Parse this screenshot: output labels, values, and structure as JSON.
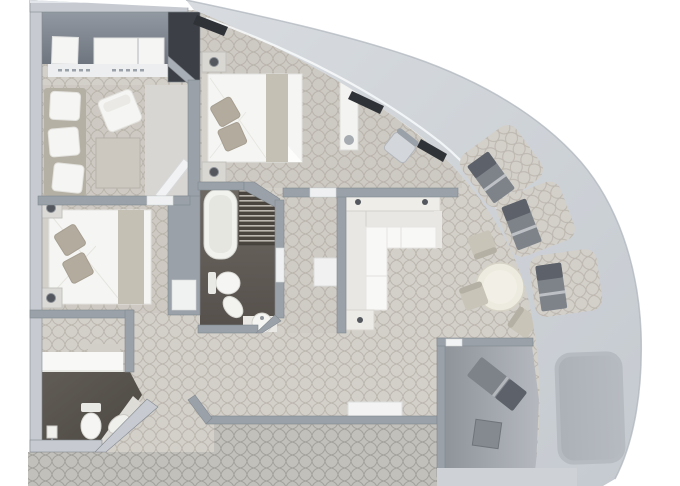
{
  "plan": {
    "kind": "floor-plan",
    "shape": "quarter-circle suite with curved hull balcony",
    "visible_text": [],
    "rooms": [
      {
        "name": "wardrobe-luggage-room",
        "furniture": [
          "storage-box",
          "luggage-bench",
          "sliding-closet-doors"
        ]
      },
      {
        "name": "sitting-room",
        "furniture": [
          "wall-sofa",
          "armchair",
          "coffee-table",
          "open-door"
        ]
      },
      {
        "name": "bedroom-2",
        "furniture": [
          "double-bed",
          "bed-runner",
          "pillows",
          "nightstand-left-top",
          "nightstand-left-bottom",
          "table-lamps"
        ]
      },
      {
        "name": "powder-room",
        "furniture": [
          "toilet",
          "vanity-counter",
          "angled-sink-counter",
          "paper-holder"
        ]
      },
      {
        "name": "master-bedroom",
        "furniture": [
          "double-bed",
          "bed-runner",
          "pillows",
          "nightstand-top",
          "nightstand-bottom",
          "wardrobe-column",
          "desk-chair"
        ]
      },
      {
        "name": "master-bathroom",
        "furniture": [
          "bathtub",
          "slatted-bench",
          "toilet",
          "bidet",
          "round-sink",
          "counter"
        ]
      },
      {
        "name": "dressing-corridor",
        "furniture": [
          "bench-shelf"
        ]
      },
      {
        "name": "living-room",
        "furniture": [
          "sectional-sofa",
          "console-table",
          "side-table",
          "dining-table",
          "dining-chairs",
          "media-bench"
        ]
      },
      {
        "name": "private-balcony-room",
        "furniture": [
          "lounge-chair",
          "side-table"
        ]
      },
      {
        "name": "balcony-band",
        "furniture": [
          "lounger-1",
          "lounger-2",
          "lounger-3",
          "plain-deck-inset",
          "window-slits",
          "glazing-line"
        ]
      },
      {
        "name": "public-corridor",
        "furniture": []
      }
    ],
    "counts": {
      "balcony_loungers": 3,
      "dining_chairs": 3,
      "bedrooms": 2,
      "bathrooms": 2
    }
  },
  "colors": {
    "outer_wall": "#c7cbd1",
    "outer_wall_hi": "#e2e5e9",
    "inner_wall": "#9aa1a9",
    "wall_edge": "#83898f",
    "hull_light": "#d8dce0",
    "hull_dark": "#c5cad0",
    "hull_edge": "#adb3ba",
    "suite_carpet": "#d3d0ca",
    "suite_lattice": "#a59e94",
    "corridor_carpet": "#c2c0ba",
    "corridor_lattice": "#8b8882",
    "bedroom_tint": "#b0aa9f",
    "dark_floor_a": "#615c56",
    "dark_floor_b": "#4b4741",
    "bath_floor_a": "#6e6862",
    "bath_floor_b": "#55504b",
    "closet_floor_a": "#939aa3",
    "closet_floor_b": "#6e757e",
    "shaft_dark": "#3c4046",
    "white_furniture": "#f5f6f4",
    "cream_furniture": "#ebe9e2",
    "beige_furniture": "#c9c4b8",
    "beige_dark": "#b5b0a4",
    "pillow": "#b3ab9d",
    "runner": "#c5c0b4",
    "gray_furniture": "#7e838a",
    "gray_furniture_dark": "#5d626a",
    "balcony_inset": "#b6bbc1",
    "private_floor_a": "#8f949b",
    "private_floor_b": "#b5b9bf",
    "window_dark": "#2f3338",
    "glass": "#f8fafc",
    "knob": "#54585e",
    "table_top": "#edebdf"
  }
}
